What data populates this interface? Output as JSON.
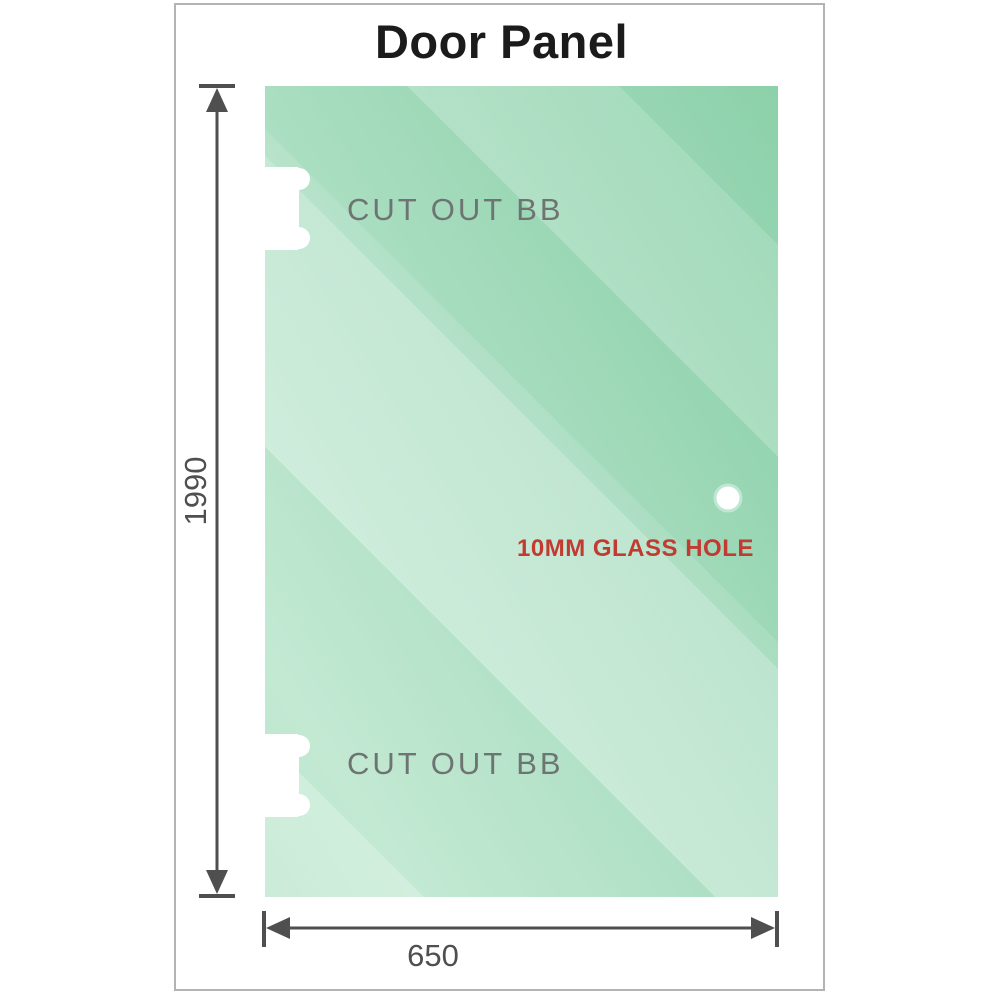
{
  "title": "Door Panel",
  "panel": {
    "cutout_top_label": "CUT OUT BB",
    "cutout_bottom_label": "CUT OUT BB",
    "hole_label": "10MM GLASS HOLE"
  },
  "dimensions": {
    "height_value": "1990",
    "width_value": "650"
  },
  "colors": {
    "glass_green_dark": "#82cda2",
    "glass_green_light": "#c3e9d3",
    "dimension_line": "#4f4f4f",
    "cutout_label_text": "#6d7472",
    "hole_label_text": "#c23b32",
    "frame_border": "#b3b3b3",
    "title_text": "#1b1b1b",
    "cutout_fill": "#ffffff"
  },
  "icons": {
    "cutout_top": "hinge-cutout-shape",
    "cutout_bottom": "hinge-cutout-shape",
    "glass_hole": "round-hole",
    "vertical_dimension": "double-headed-arrow-vertical",
    "horizontal_dimension": "double-headed-arrow-horizontal"
  }
}
